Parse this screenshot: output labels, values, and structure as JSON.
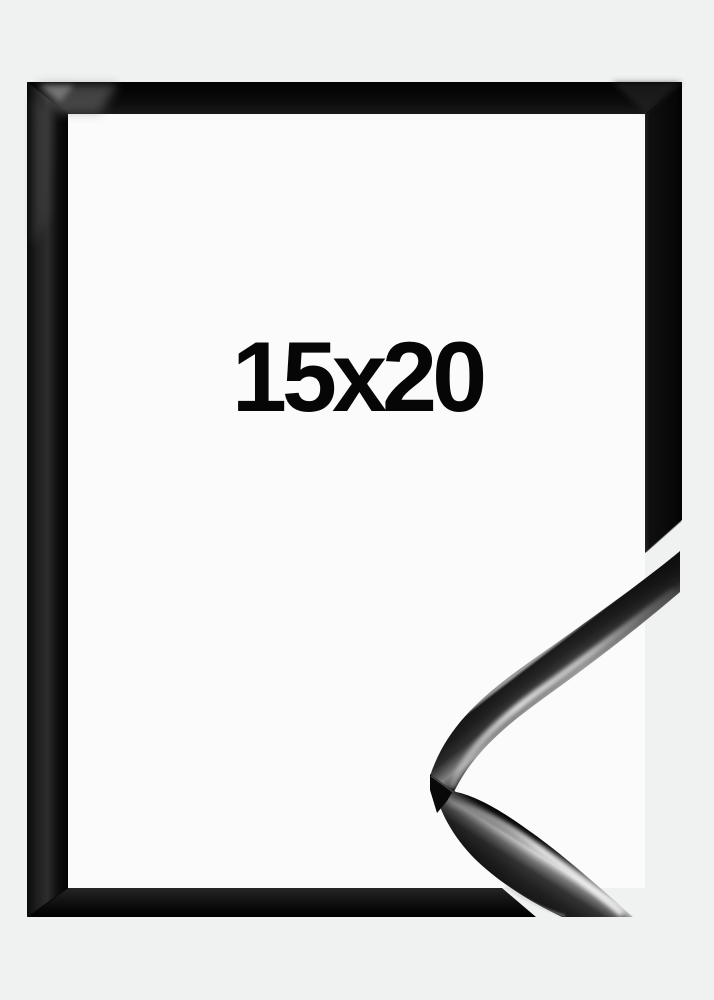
{
  "frame": {
    "size_label": "15x20"
  },
  "colors": {
    "background": "#f0f1f1",
    "frame_opening": "#fbfbfc",
    "frame_gloss_black": "#0d0d0d",
    "specular_highlight": "#c9c9c9",
    "label_text": "#060606"
  }
}
